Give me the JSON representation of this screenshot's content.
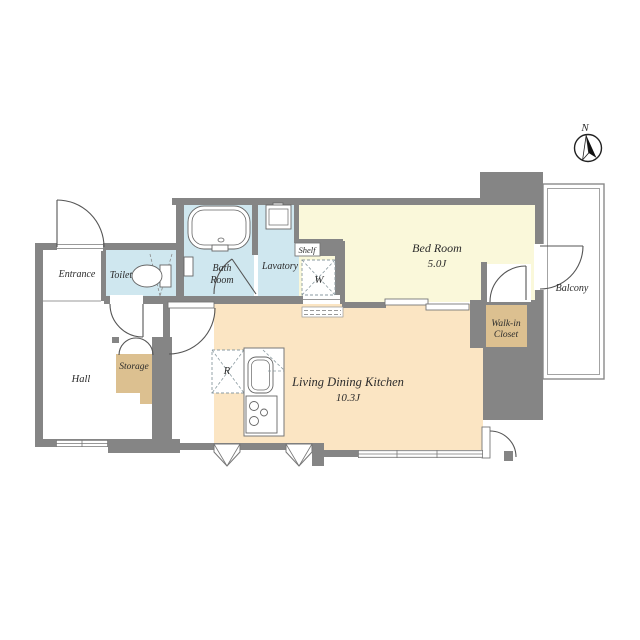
{
  "compass": {
    "north": "N"
  },
  "colors": {
    "wall": "#858585",
    "wet_area_floor": "#cfe7ef",
    "bedroom_floor": "#faf8da",
    "ldk_floor": "#fbe5c3",
    "closet_floor": "#dcc090",
    "label_text": "#2b2b2b"
  },
  "rooms": {
    "entrance": {
      "name": "Entrance"
    },
    "toilet": {
      "name": "Toilet"
    },
    "bath_room": {
      "line1": "Bath",
      "line2": "Room"
    },
    "lavatory": {
      "name": "Lavatory"
    },
    "shelf": {
      "name": "Shelf"
    },
    "washing_machine": {
      "symbol": "W"
    },
    "bed_room": {
      "name": "Bed Room",
      "area": "5.0J"
    },
    "balcony": {
      "name": "Balcony"
    },
    "walk_in_closet": {
      "line1": "Walk-in",
      "line2": "Closet"
    },
    "storage": {
      "name": "Storage"
    },
    "refrigerator": {
      "symbol": "R"
    },
    "hall": {
      "name": "Hall"
    },
    "ldk": {
      "name": "Living Dining Kitchen",
      "area": "10.3J"
    }
  }
}
